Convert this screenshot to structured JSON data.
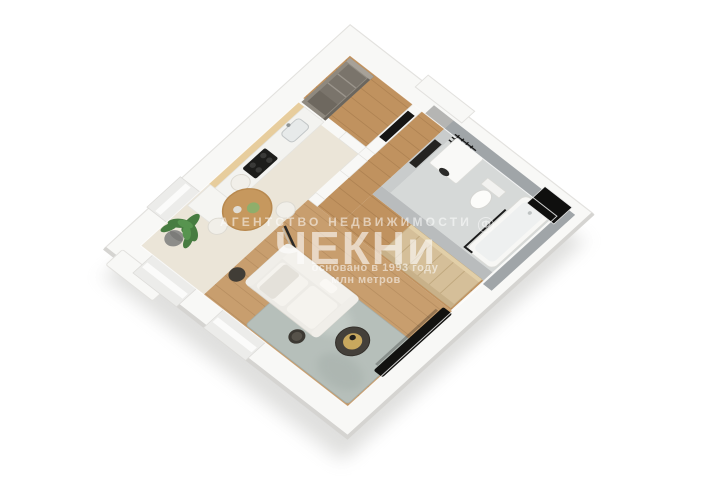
{
  "watermark": {
    "agency_line": "АГЕНТСТВО НЕДВИЖИМОСТИ",
    "logo_mark": "Ф",
    "brand": "ЧЕКНи",
    "founded_line": "основано в 1993 году",
    "metric_line": "млн метров",
    "text_color": "#ffffff"
  },
  "palette": {
    "background": "#ffffff",
    "wall": "#f8f8f6",
    "wall_edge": "#e0dfdc",
    "outer_shadow": "#c9c9c6",
    "wood_floor": "#c0925f",
    "wood_floor_living": "#c89e6e",
    "carpet": "#ebe5d8",
    "kitchen_wood": "#e7cd9d",
    "counter": "#f3f3f0",
    "grey_cabinet": "#8f897f",
    "grey_cabinet_dark": "#6e685f",
    "beige_cabinet": "#d5bf99",
    "bath_wall": "#a0a5a8",
    "bath_wall_light": "#b9bcbd",
    "bath_floor": "#d6d9d8",
    "fixture_white": "#f9f9f7",
    "dark": "#161514",
    "rug": "#b6bfba",
    "sofa": "#edebe6",
    "plant_green": "#477c41",
    "plant_pot": "#8d8d8a",
    "table_wood": "#c6985e"
  }
}
